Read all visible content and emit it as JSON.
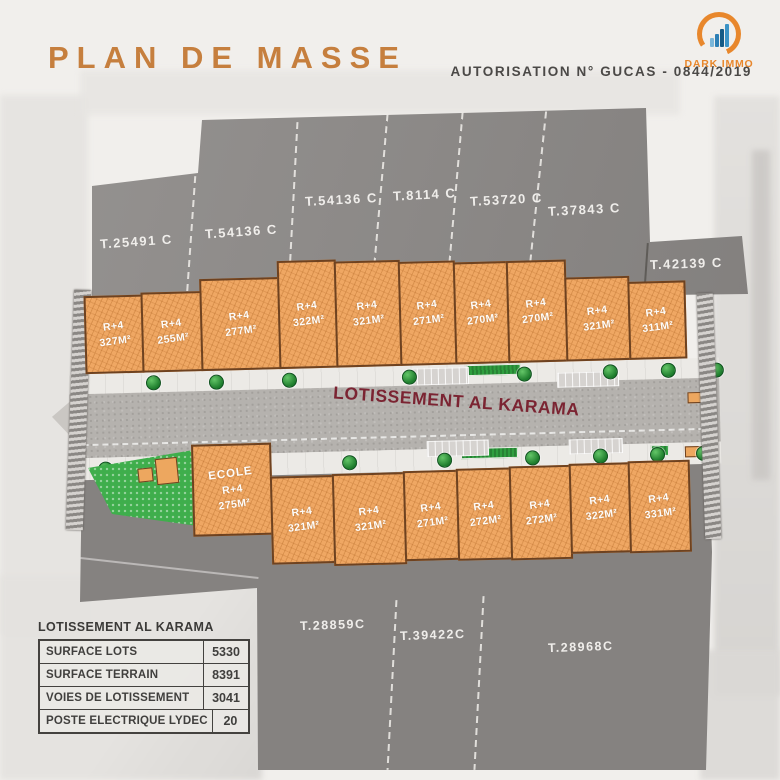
{
  "header": {
    "title": "PLAN DE MASSE",
    "authorization": "AUTORISATION N° GUCAS - 0844/2019",
    "logo": {
      "name": "DARK IMMO"
    }
  },
  "plan": {
    "road_label": "LOTISSEMENT AL KARAMA",
    "surrounding_parcels": {
      "top": [
        "T.25491 C",
        "T.54136 C",
        "T.54136 C",
        "T.8114 C",
        "T.53720 C",
        "T.37843 C",
        "T.42139 C"
      ],
      "bottom": [
        "T.28859C",
        "T.39422C",
        "T.28968C"
      ]
    },
    "lots_top": [
      {
        "floors": "R+4",
        "area": "327M²"
      },
      {
        "floors": "R+4",
        "area": "255M²"
      },
      {
        "floors": "R+4",
        "area": "277M²"
      },
      {
        "floors": "R+4",
        "area": "322M²"
      },
      {
        "floors": "R+4",
        "area": "321M²"
      },
      {
        "floors": "R+4",
        "area": "271M²"
      },
      {
        "floors": "R+4",
        "area": "270M²"
      },
      {
        "floors": "R+4",
        "area": "270M²"
      },
      {
        "floors": "R+4",
        "area": "321M²"
      },
      {
        "floors": "R+4",
        "area": "311M²"
      }
    ],
    "lots_bottom": [
      {
        "name": "ECOLE",
        "floors": "R+4",
        "area": "275M²"
      },
      {
        "floors": "R+4",
        "area": "321M²"
      },
      {
        "floors": "R+4",
        "area": "321M²"
      },
      {
        "floors": "R+4",
        "area": "271M²"
      },
      {
        "floors": "R+4",
        "area": "272M²"
      },
      {
        "floors": "R+4",
        "area": "272M²"
      },
      {
        "floors": "R+4",
        "area": "322M²"
      },
      {
        "floors": "R+4",
        "area": "331M²"
      }
    ]
  },
  "summary_table": {
    "title": "LOTISSEMENT AL KARAMA",
    "rows": [
      {
        "label": "SURFACE LOTS",
        "value": "5330"
      },
      {
        "label": "SURFACE TERRAIN",
        "value": "8391"
      },
      {
        "label": "VOIES DE LOTISSEMENT",
        "value": "3041"
      },
      {
        "label": "POSTE ELECTRIQUE LYDEC",
        "value": "20"
      }
    ]
  },
  "colors": {
    "accent_orange": "#c67f3e",
    "logo_orange": "#e8872c",
    "logo_blue_dark": "#155a85",
    "logo_blue": "#2d7fb5",
    "logo_blue_light": "#7ab6d9",
    "lot_fill": "#efa763",
    "lot_border": "#6e4220",
    "parcel_gray": "#8d8a88",
    "road_gray": "#b5b2ae",
    "road_label_maroon": "#7b2432",
    "park_green": "#3fae4c",
    "tree_green": "#1d7c2c",
    "table_ink": "#403f3d"
  }
}
